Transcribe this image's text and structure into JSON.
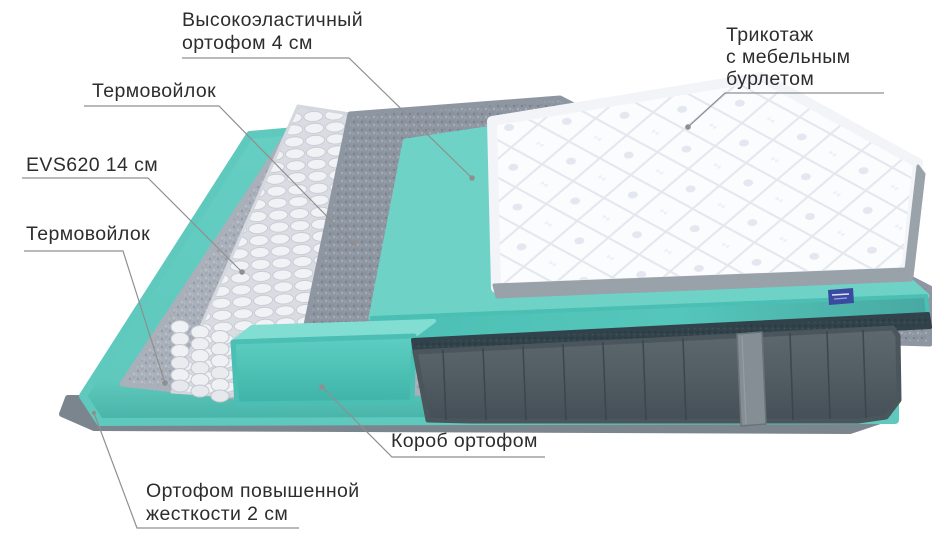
{
  "labels": {
    "elastic_foam": "Высокоэластичный\nортофом 4 см",
    "thermo_felt_top": "Термовойлок",
    "spring_block": "EVS620 14 см",
    "thermo_felt_bottom": "Термовойлок",
    "knit_cover": "Трикотаж\nс мебельным\nбурлетом",
    "foam_box": "Короб ортофом",
    "firm_foam": "Ортофом повышенной\nжесткости 2 см"
  },
  "colors": {
    "teal_foam": "#5fc9bd",
    "teal_foam_light": "#82ded3",
    "teal_foam_dark": "#3f9e99",
    "felt_light": "#a9b0ba",
    "felt_dark": "#8e96a2",
    "spring_white": "#f0f1f4",
    "cover_white": "#fbfcfe",
    "fabric_dark": "#515c63",
    "label_text": "#2d2d2d",
    "leader_line": "#8f8f8f",
    "brand_tag": "#3a4aa0",
    "background": "#ffffff"
  },
  "illustration_parts": [
    "knit-cover-top",
    "elastic-foam-slab",
    "thermo-felt-upper",
    "pocket-springs",
    "thermo-felt-lower",
    "foam-box",
    "firm-foam-base",
    "fabric-encasement",
    "handle-strap",
    "brand-tag"
  ]
}
